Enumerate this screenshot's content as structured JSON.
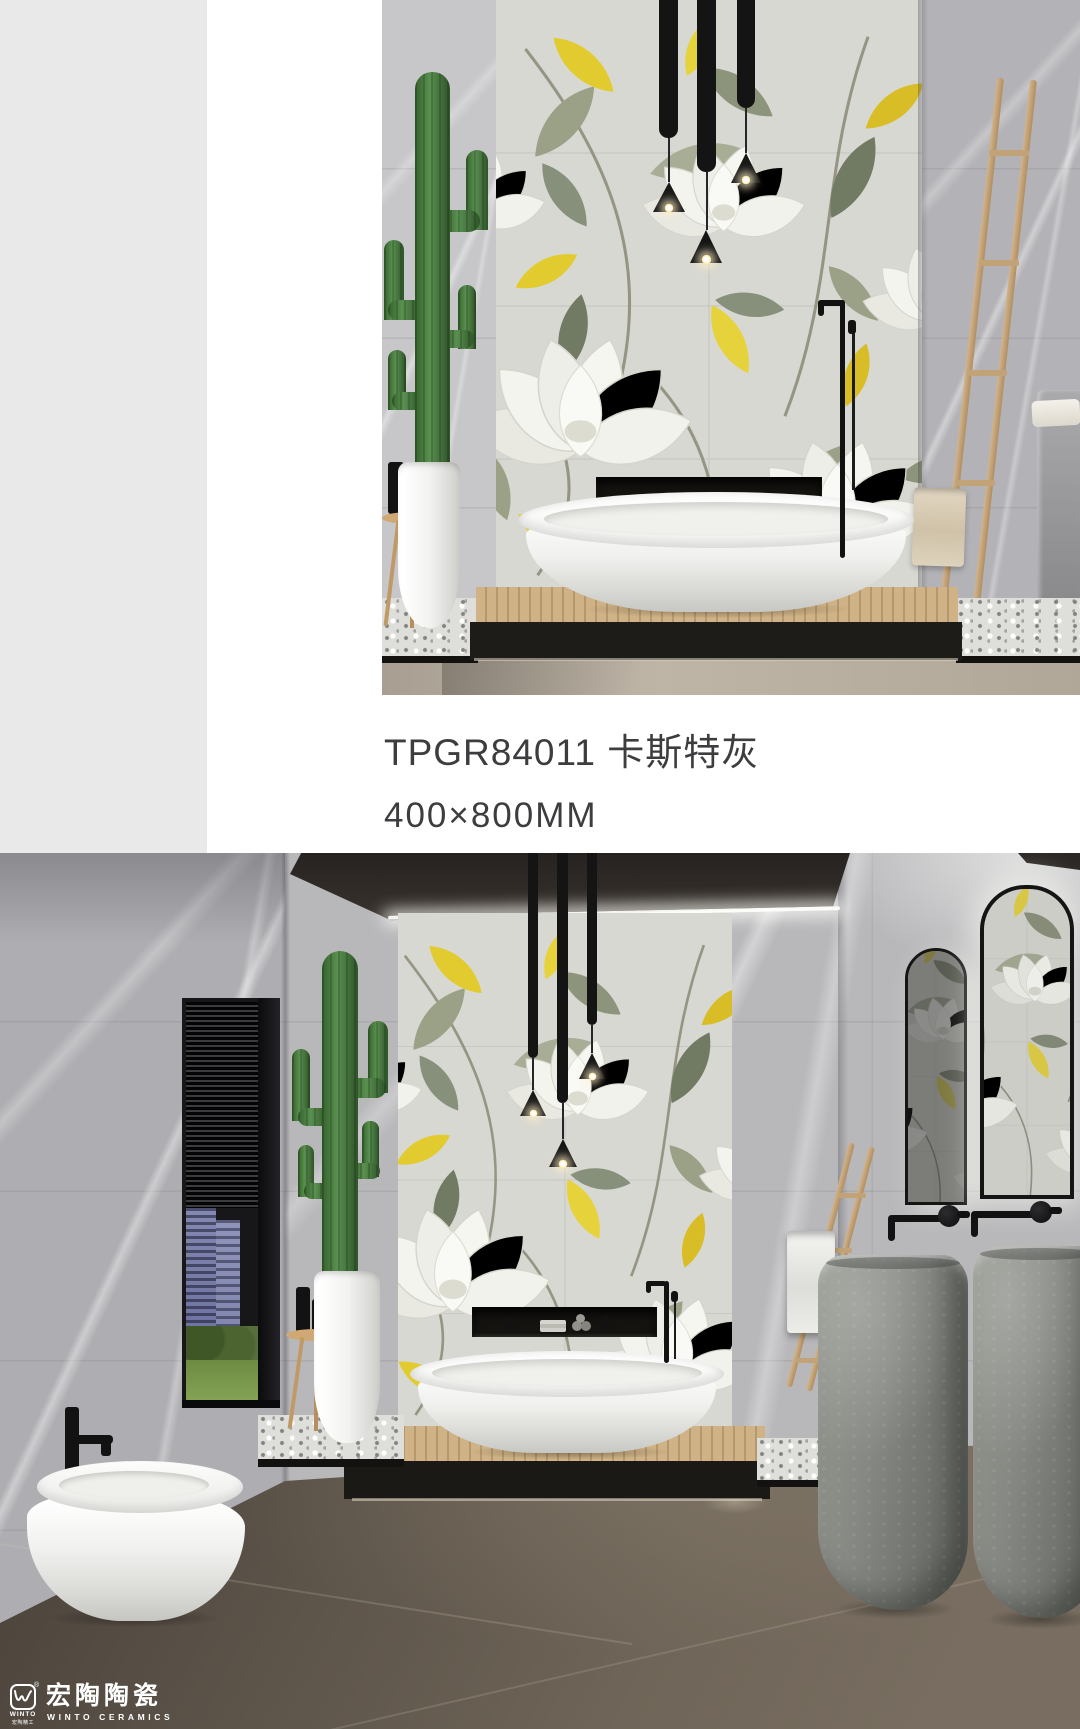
{
  "page": {
    "background": "#ffffff",
    "left_panel_color": "#e9e9e9"
  },
  "product": {
    "display_title": "TPGR84011 卡斯特灰",
    "model": "TPGR84011",
    "color_name": "卡斯特灰",
    "size_label": "400×800MM",
    "text_color": "#3d3d40"
  },
  "brand": {
    "wordmark_cn": "宏陶陶瓷",
    "wordmark_en": "WINTO CERAMICS",
    "emblem_sub_en": "WINTO",
    "emblem_sub_cn": "宏陶精工",
    "registered_mark": "®",
    "logo_color": "#ffffff"
  },
  "palette": {
    "accent_yellow": "#e2cb2e",
    "leaf_green": "#98a084",
    "marble_gray": "#b9b9bc",
    "floral_wall_base": "#d8d8d2",
    "floor_brown": "#5d544a",
    "wood_tone": "#c9ad80",
    "cactus_green": "#599050",
    "fixture_black": "#141414"
  }
}
